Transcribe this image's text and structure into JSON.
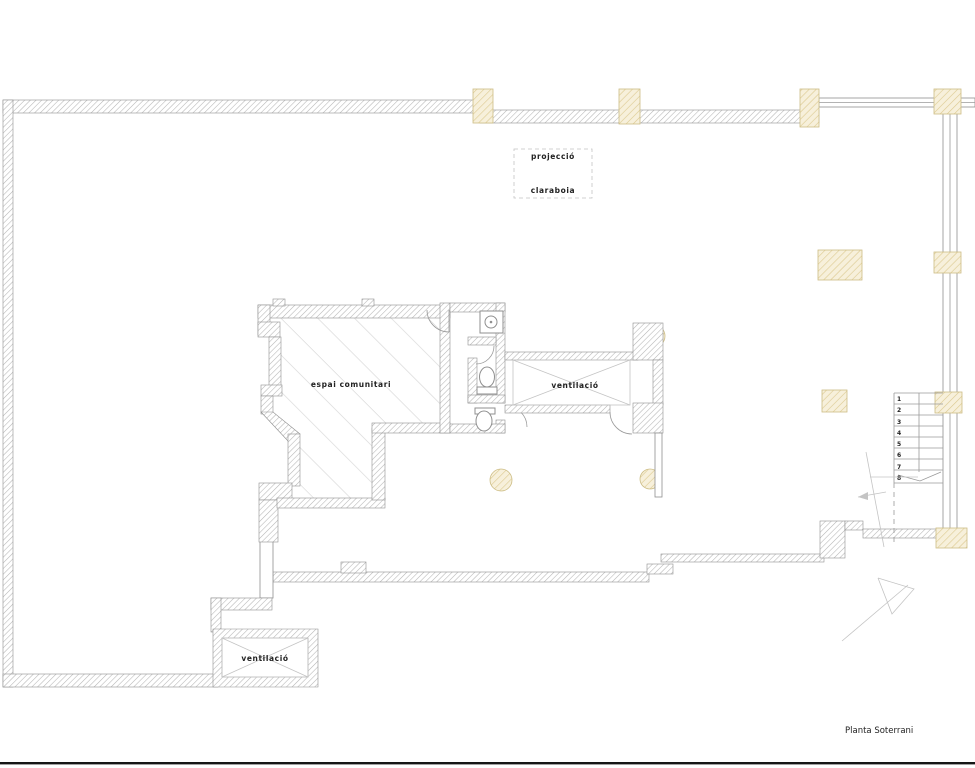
{
  "title": "Planta Soterrani",
  "labels": {
    "skylight_line1": "projecció",
    "skylight_line2": "claraboia",
    "community_room": "espai comunitari",
    "ventilation_center": "ventilació",
    "ventilation_sw": "ventilació"
  },
  "stairs": {
    "steps": [
      "1",
      "2",
      "3",
      "4",
      "5",
      "6",
      "7",
      "8"
    ]
  },
  "colors": {
    "background": "#ffffff",
    "wall_hatch": "#b5b5b5",
    "wall_outline": "#8f8f8f",
    "column_fill": "#f7f0db",
    "column_hatch": "#dcc98f",
    "column_outline": "#cdbd85",
    "room_hatch": "#d6d6d6",
    "cross_line": "#c4c4c4",
    "text": "#222222",
    "thin_line": "#9a9a9a",
    "footer_bar": "#161616"
  }
}
